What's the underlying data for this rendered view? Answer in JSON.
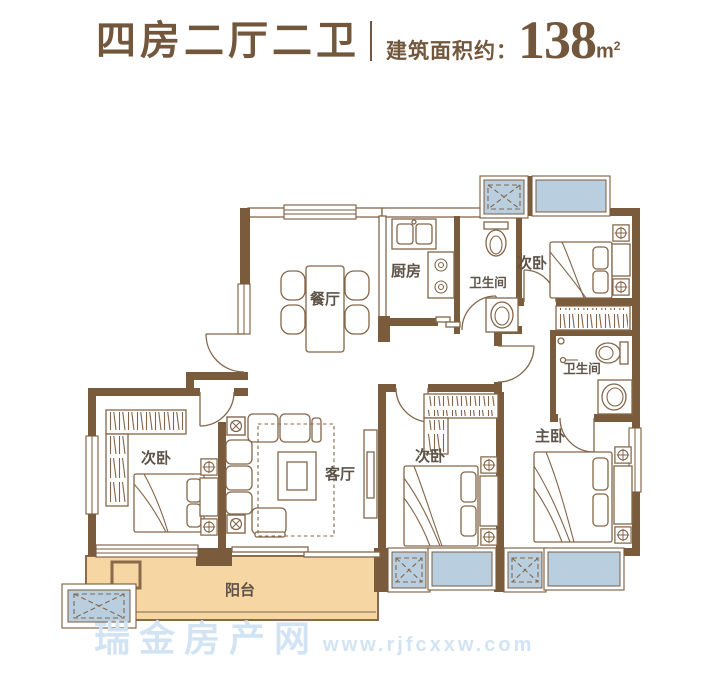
{
  "header": {
    "title": "四房二厅二卫",
    "area_label": "建筑面积约：",
    "area_value": "138",
    "area_unit": "m",
    "area_unit_exp": "2"
  },
  "rooms": {
    "dining": "餐厅",
    "kitchen": "厨房",
    "bath_top": "卫生间",
    "bath_right": "卫生间",
    "bedroom_top_right": "次卧",
    "bedroom_middle": "次卧",
    "bedroom_left": "次卧",
    "master": "主卧",
    "living": "客厅",
    "balcony": "阳台"
  },
  "watermark": {
    "name": "瑞金房产网",
    "url": "www.rjfcxxw.com"
  },
  "colors": {
    "wall": "#7a5b3c",
    "line": "#83664a",
    "label": "#5d5348",
    "window": "#b9cfe0",
    "balcony": "#f6d7a3",
    "balcony_border": "#8a6a4a",
    "title": "#72573c",
    "watermark": "#d2e4f4"
  }
}
